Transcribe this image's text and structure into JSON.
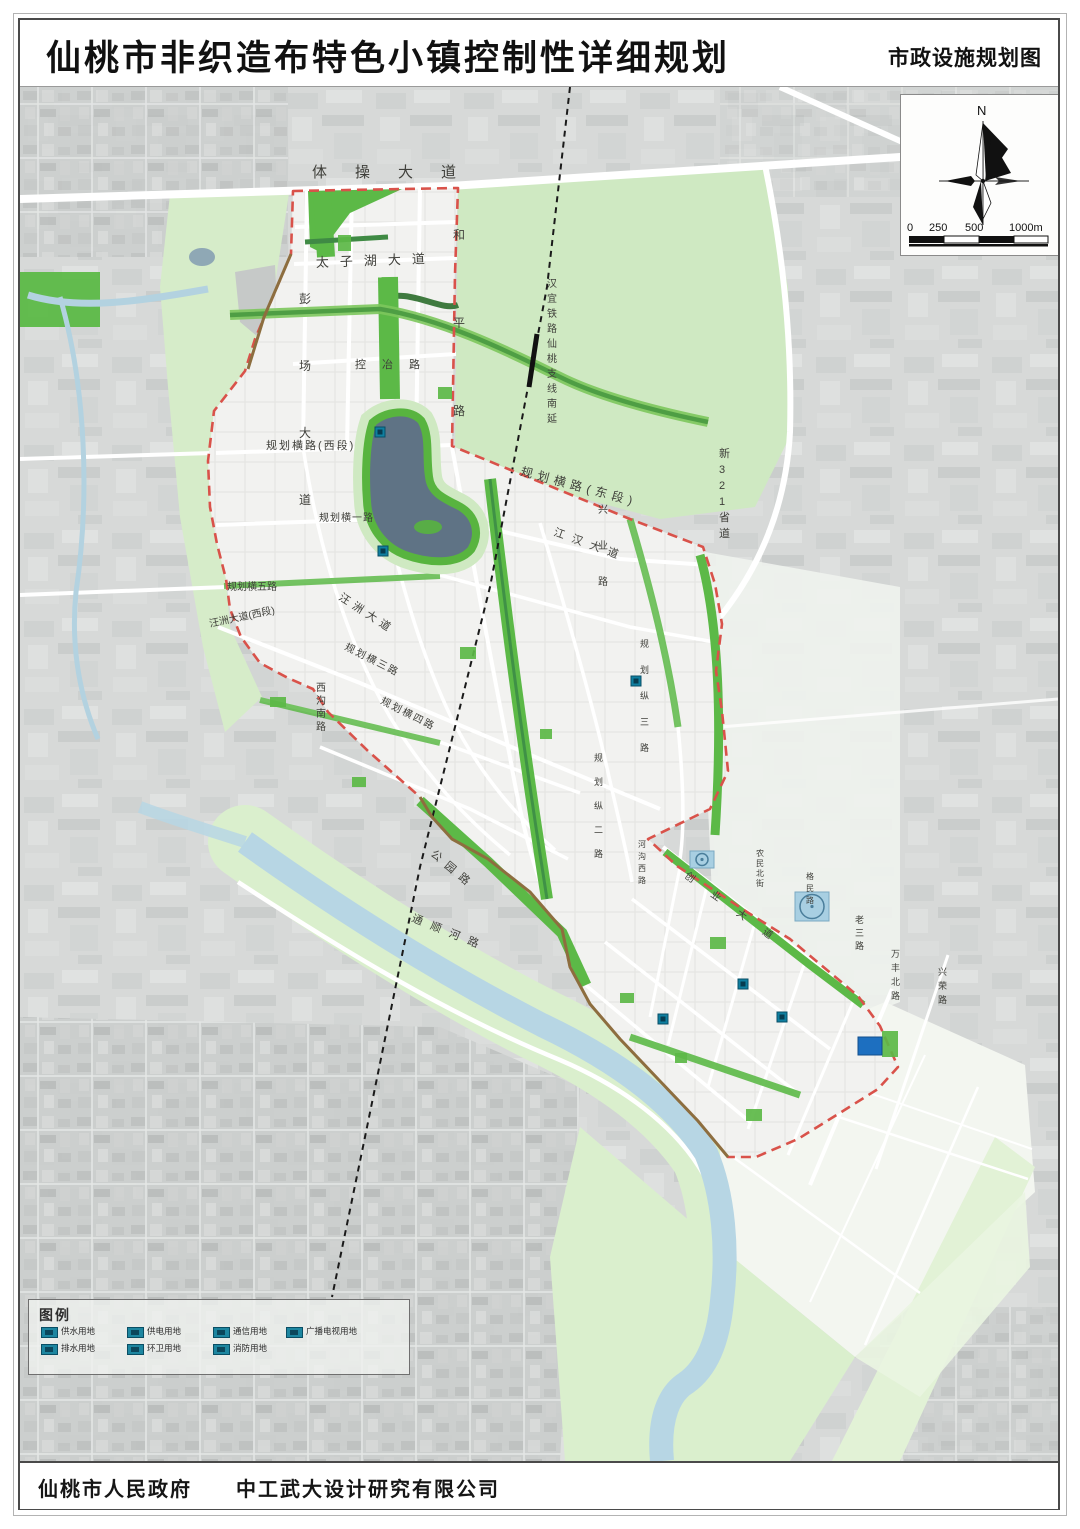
{
  "header": {
    "title": "仙桃市非织造布特色小镇控制性详细规划",
    "subtitle": "市政设施规划图"
  },
  "footer": {
    "text": "仙桃市人民政府　　中工武大设计研究有限公司"
  },
  "north": {
    "label": "N"
  },
  "scalebar": {
    "ticks": [
      "0",
      "250",
      "500",
      "1000m"
    ]
  },
  "legend": {
    "title": "图例",
    "items": [
      {
        "label": "供水用地",
        "color": "#1d86a0"
      },
      {
        "label": "供电用地",
        "color": "#1d86a0"
      },
      {
        "label": "通信用地",
        "color": "#1d86a0"
      },
      {
        "label": "广播电视用地",
        "color": "#1d86a0"
      },
      {
        "label": "排水用地",
        "color": "#1d86a0"
      },
      {
        "label": "环卫用地",
        "color": "#1d86a0"
      },
      {
        "label": "消防用地",
        "color": "#1d86a0"
      }
    ]
  },
  "map": {
    "colors": {
      "boundary_red": "#d9524a",
      "levee_brown": "#8d6e3f",
      "green": "#5cb947",
      "pale_green": "#d8eecb",
      "water": "#b7d6e4",
      "lake": "#5f7385",
      "facility_teal": "#0f7fa0",
      "facility_lightblue": "#a8cfe2",
      "facility_blue": "#1d6fc0"
    },
    "road_labels": [
      {
        "t": "体操大道",
        "x": 292,
        "y": 90,
        "s": 15,
        "sp": 28
      },
      {
        "t": "太子湖大道",
        "x": 296,
        "y": 180,
        "s": 13,
        "sp": 11,
        "r": -2
      },
      {
        "t": "和平路",
        "x": 433,
        "y": 152,
        "s": 12,
        "v": 1,
        "dy": 88
      },
      {
        "t": "彭场大道",
        "x": 279,
        "y": 216,
        "s": 12,
        "v": 1,
        "dy": 67
      },
      {
        "t": "控冶路",
        "x": 335,
        "y": 281,
        "s": 11,
        "sp": 16
      },
      {
        "t": "规划横路(西段)",
        "x": 246,
        "y": 362,
        "s": 11,
        "sp": 2
      },
      {
        "t": "规划横一路",
        "x": 299,
        "y": 434,
        "s": 10,
        "sp": 1
      },
      {
        "t": "规划横五路",
        "x": 207,
        "y": 503,
        "s": 10,
        "sp": 0
      },
      {
        "t": "汪洲大道(西段)",
        "x": 190,
        "y": 540,
        "s": 10,
        "r": -12
      },
      {
        "t": "汪洲大道",
        "x": 318,
        "y": 512,
        "s": 11,
        "r": 33,
        "sp": 5
      },
      {
        "t": "规划横三路",
        "x": 324,
        "y": 562,
        "s": 10,
        "r": 27,
        "sp": 2
      },
      {
        "t": "规划横四路",
        "x": 360,
        "y": 616,
        "s": 10,
        "r": 27,
        "sp": 2
      },
      {
        "t": "西沟南路",
        "x": 296,
        "y": 604,
        "s": 10,
        "v": 1,
        "dy": 13
      },
      {
        "t": "公园路",
        "x": 410,
        "y": 768,
        "s": 11,
        "r": 40,
        "sp": 7
      },
      {
        "t": "通顺河路",
        "x": 391,
        "y": 834,
        "s": 11,
        "r": 22,
        "sp": 9
      },
      {
        "t": "规划横路(东段)",
        "x": 500,
        "y": 388,
        "s": 12,
        "r": 15,
        "sp": 5
      },
      {
        "t": "新321省道",
        "x": 699,
        "y": 370,
        "s": 11,
        "v": 1,
        "dy": 16
      },
      {
        "t": "汉宜铁路仙桃支线南延",
        "x": 527,
        "y": 200,
        "s": 10,
        "v": 1,
        "dy": 15
      },
      {
        "t": "江汉大道",
        "x": 533,
        "y": 448,
        "s": 11,
        "r": 20,
        "sp": 8
      },
      {
        "t": "兴业路",
        "x": 578,
        "y": 426,
        "s": 10,
        "v": 1,
        "dy": 36
      },
      {
        "t": "规划纵二路",
        "x": 574,
        "y": 674,
        "s": 9,
        "v": 1,
        "dy": 24
      },
      {
        "t": "规划纵三路",
        "x": 620,
        "y": 560,
        "s": 9,
        "v": 1,
        "dy": 26
      },
      {
        "t": "创业大道",
        "x": 664,
        "y": 790,
        "s": 10,
        "r": 36,
        "sp": 22
      },
      {
        "t": "河沟西路",
        "x": 618,
        "y": 760,
        "s": 8,
        "v": 1,
        "dy": 12
      },
      {
        "t": "农民北街",
        "x": 736,
        "y": 769,
        "s": 8,
        "v": 1,
        "dy": 10
      },
      {
        "t": "格民路",
        "x": 786,
        "y": 792,
        "s": 8,
        "v": 1,
        "dy": 12
      },
      {
        "t": "万丰北路",
        "x": 871,
        "y": 870,
        "s": 9,
        "v": 1,
        "dy": 14
      },
      {
        "t": "老三路",
        "x": 835,
        "y": 836,
        "s": 9,
        "v": 1,
        "dy": 13
      },
      {
        "t": "兴荣路",
        "x": 918,
        "y": 888,
        "s": 9,
        "v": 1,
        "dy": 14
      }
    ],
    "facilities": {
      "teal": [
        [
          360,
          345
        ],
        [
          363,
          464
        ],
        [
          616,
          594
        ],
        [
          723,
          897
        ],
        [
          762,
          930
        ],
        [
          643,
          932
        ]
      ],
      "lightblue": [
        [
          670,
          764,
          24,
          17
        ],
        [
          775,
          805,
          34,
          29
        ]
      ],
      "blue": [
        [
          838,
          950,
          24,
          18
        ]
      ],
      "green_spots": [
        [
          690,
          850,
          16,
          12
        ],
        [
          600,
          906,
          14,
          10
        ],
        [
          726,
          1022,
          16,
          12
        ],
        [
          655,
          966,
          12,
          10
        ],
        [
          862,
          944,
          16,
          26
        ],
        [
          250,
          610,
          16,
          10
        ],
        [
          332,
          690,
          14,
          10
        ],
        [
          440,
          560,
          16,
          12
        ],
        [
          520,
          642,
          12,
          10
        ],
        [
          318,
          148,
          13,
          16
        ],
        [
          418,
          300,
          14,
          12
        ]
      ]
    }
  }
}
